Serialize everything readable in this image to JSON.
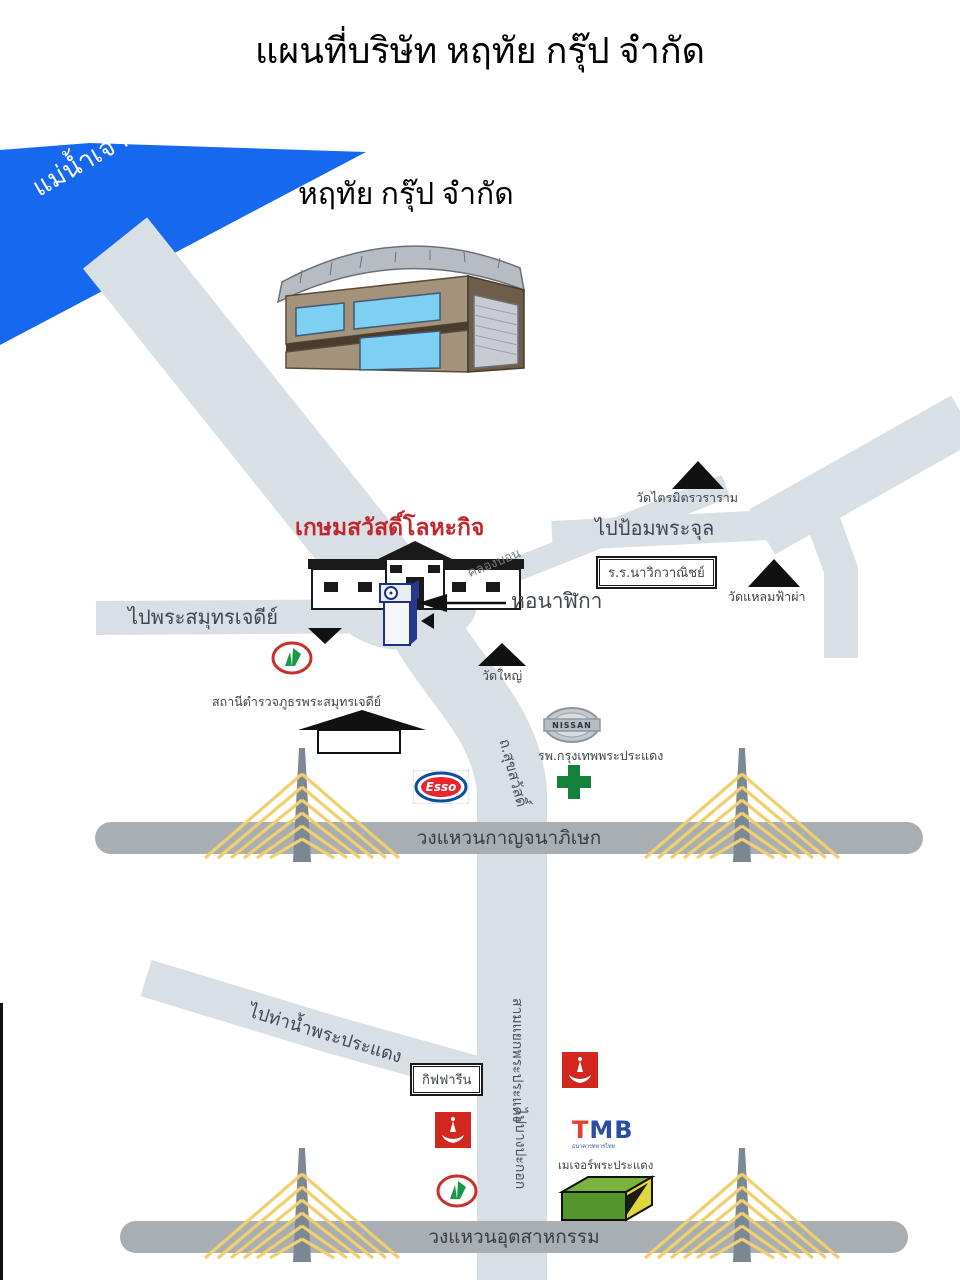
{
  "title": "แผนที่บริษัท หฤทัย กรุ๊ป จำกัด",
  "river": {
    "label": "แม่น้ำเจ้าพระยา"
  },
  "company": {
    "label": "หฤทัย กรุ๊ป จำกัด"
  },
  "places": {
    "kasem": "เกษมสวัสดิ์โลหะกิจ",
    "klong": "คลองบอน",
    "pom_phrachul": "ไปป้อมพระจุล",
    "wat_trimit": "วัดไตรมิตรวราราม",
    "school": "ร.ร.นาวิกวาณิชย์",
    "wat_laem": "วัดแหลมฟ้าผ่า",
    "clock_tower": "หอนาฬิกา",
    "pai_phrasamut": "ไปพระสมุทรเจดีย์",
    "wat_yai": "วัดใหญ่",
    "police_station": "สถานีตำรวจภูธรพระสมุทรเจดีย์",
    "hospital": "รพ.กรุงเทพพระประแดง",
    "suksawat_rd": "ถ.สุขสวัสดิ์",
    "ring_kanchanaphisek": "วงแหวนกาญจนาภิเษก",
    "pai_thanam": "ไปท่าน้ำพระประแดง",
    "giffarine": "กิฟฟารีน",
    "samyaek": "สามแยกพระประแดง",
    "pai_bangpakok": "ไปบางปะกอก",
    "major": "เมเจอร์พระประแดง",
    "ring_industrial": "วงแหวนอุตสาหกรรม"
  },
  "logos": {
    "nissan": "NISSAN",
    "esso": "Esso",
    "tmb": "TMB",
    "tmb_sub": "ธนาคารทหารไทย"
  },
  "colors": {
    "river_blue": "#1668ee",
    "road_light": "#d9e0e5",
    "ring_road_gray": "#a9aeb3",
    "bridge_cable_yellow": "#f0cf6e",
    "bridge_pylon_gray": "#7b8894",
    "landmark_red_text": "#c1272d",
    "kasikorn_green": "#169a49",
    "kasikorn_ring_red": "#c9302a",
    "esso_red": "#e8262d",
    "esso_blue": "#0c4da2",
    "tmb_red": "#e63f2b",
    "tmb_blue": "#2b4ea3",
    "hospital_cross_green": "#15823c",
    "bank_logo_red": "#d2271f",
    "major_box_green": "#55962c"
  }
}
